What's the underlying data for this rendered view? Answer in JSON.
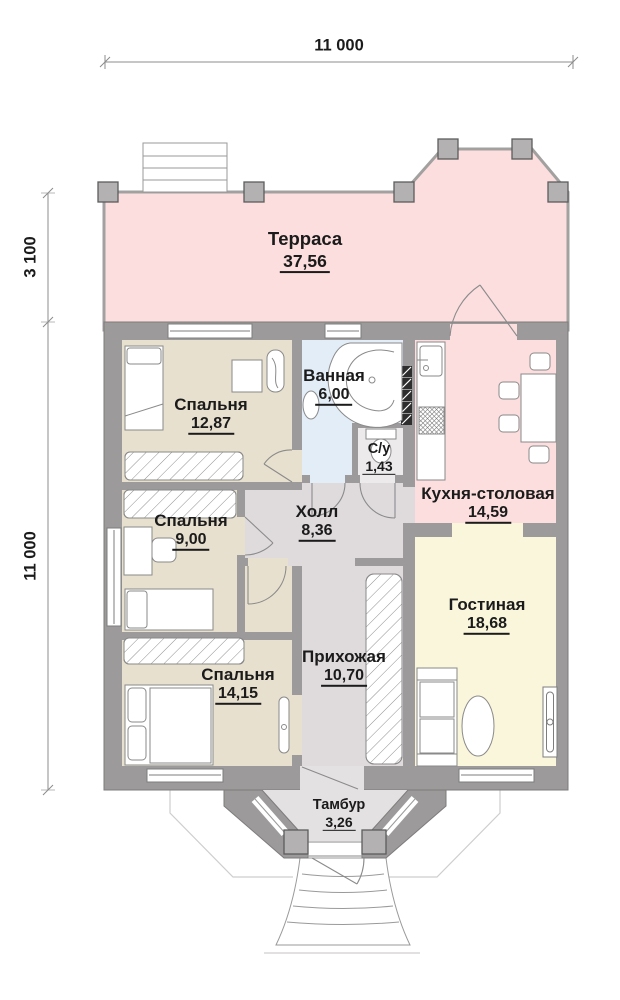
{
  "dimensions": {
    "width_top": "11 000",
    "terrace_depth_left": "3 100",
    "house_depth_left": "11 000"
  },
  "rooms": {
    "terrace": {
      "name": "Терраса",
      "area": "37,56"
    },
    "bedroom1": {
      "name": "Спальня",
      "area": "12,87"
    },
    "bathroom": {
      "name": "Ванная",
      "area": "6,00"
    },
    "wc": {
      "name": "С/у",
      "area": "1,43"
    },
    "kitchen": {
      "name": "Кухня-столовая",
      "area": "14,59"
    },
    "hall": {
      "name": "Холл",
      "area": "8,36"
    },
    "bedroom2": {
      "name": "Спальня",
      "area": "9,00"
    },
    "living": {
      "name": "Гостиная",
      "area": "18,68"
    },
    "bedroom3": {
      "name": "Спальня",
      "area": "14,15"
    },
    "entry": {
      "name": "Прихожая",
      "area": "10,70"
    },
    "vestibule": {
      "name": "Тамбур",
      "area": "3,26"
    }
  },
  "colors": {
    "terrace_floor": "#fbdedd",
    "kitchen_floor": "#fbdedd",
    "bedroom_floor": "#e7e0ce",
    "bathroom_floor": "#e3edf8",
    "hall_floor": "#dfdbdd",
    "living_floor": "#f9f6dc",
    "wall": "#9c9a9a"
  }
}
